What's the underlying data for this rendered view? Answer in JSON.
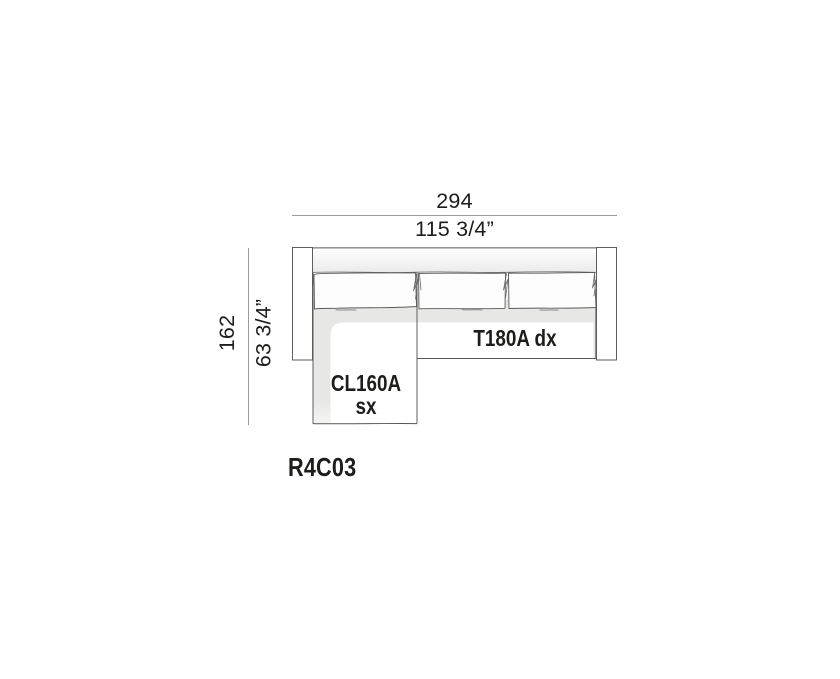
{
  "figure": {
    "product_code": "R4C03",
    "dimensions": {
      "overall_width": {
        "cm": "294",
        "inches": "115 3/4”"
      },
      "overall_depth": {
        "cm": "162",
        "inches": "63 3/4”"
      }
    },
    "modules": {
      "sofa_right": {
        "label": "T180A dx"
      },
      "chaise_left": {
        "line1": "CL160A",
        "line2": "sx"
      }
    }
  },
  "colors": {
    "ink": "#1d1d1b",
    "dim_line": "#9c9c9c",
    "outline": "#575756",
    "deck": "#e7e7e6",
    "background": "#ffffff"
  }
}
